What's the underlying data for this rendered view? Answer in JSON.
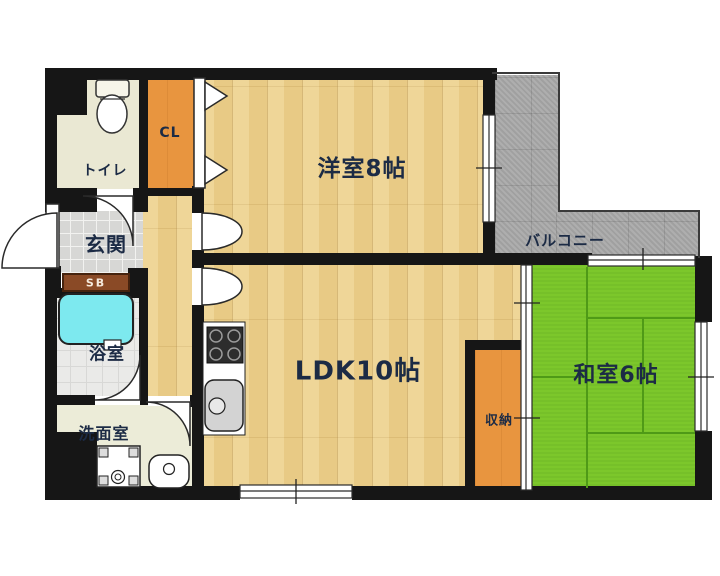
{
  "floorplan": {
    "rooms": {
      "toilet": {
        "label": "トイレ"
      },
      "closet": {
        "label": "CL"
      },
      "western_room": {
        "label": "洋室8帖"
      },
      "balcony": {
        "label": "バルコニー"
      },
      "entrance": {
        "label": "玄関"
      },
      "shoe_box": {
        "label": "SB"
      },
      "bathroom": {
        "label": "浴室"
      },
      "washroom": {
        "label": "洗面室"
      },
      "ldk": {
        "label": "LDK10帖"
      },
      "storage": {
        "label": "収納"
      },
      "japanese_room": {
        "label": "和室6帖"
      }
    },
    "colors": {
      "wall": "#161616",
      "wood_floor": "#edd18c",
      "tatami_green": "#7cc72b",
      "closet_orange": "#e8953f",
      "balcony_gray": "#a9a9a9",
      "bathtub_cyan": "#7de9ef",
      "shoe_box_brown": "#8a4a26",
      "label_text": "#1c2b45"
    }
  }
}
